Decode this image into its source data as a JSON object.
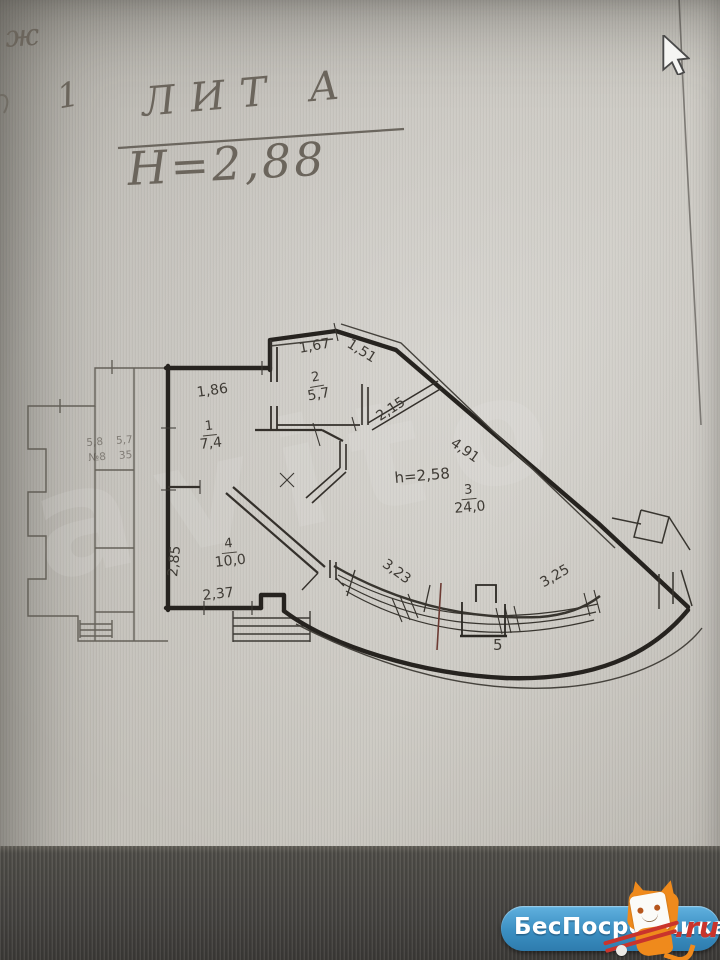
{
  "handwritten": {
    "corner_letter": "ж",
    "sheet_number": "1",
    "liter": "ЛИТ А",
    "floor_height": "Н=2,88"
  },
  "plan": {
    "ceiling_height": "h=2,58",
    "rooms": {
      "r1n": "1",
      "r1a": "7,4",
      "r2n": "2",
      "r2a": "5,7",
      "r3n": "3",
      "r3a": "24,0",
      "r4n": "4",
      "r4a": "10,0",
      "balcony_n": "5"
    },
    "dims": {
      "d167": "1,67",
      "d151": "1,51",
      "d186": "1,86",
      "d215": "2,15",
      "d491": "4,91",
      "d285": "2,85",
      "d237": "2,37",
      "d323": "3,23",
      "d325": "3,25"
    },
    "neighbor_faint": {
      "row1_left": "5,8",
      "row1_right": "5,7",
      "row2_left": "№8",
      "row2_right": "35"
    }
  },
  "watermark": {
    "text": "avito"
  },
  "logo": {
    "site_name": "БесПосредника",
    "tld": ".ru"
  },
  "icons": {
    "cursor": "mouse-cursor-icon",
    "mascot": "mascot-cat-icon"
  },
  "colors": {
    "paper": "#c4c1ba",
    "ink": "#26231f",
    "dark_band": "#494744",
    "logo_blue": "#3b8fc2",
    "logo_orange": "#ef8a1c",
    "logo_red": "#c9342c"
  }
}
